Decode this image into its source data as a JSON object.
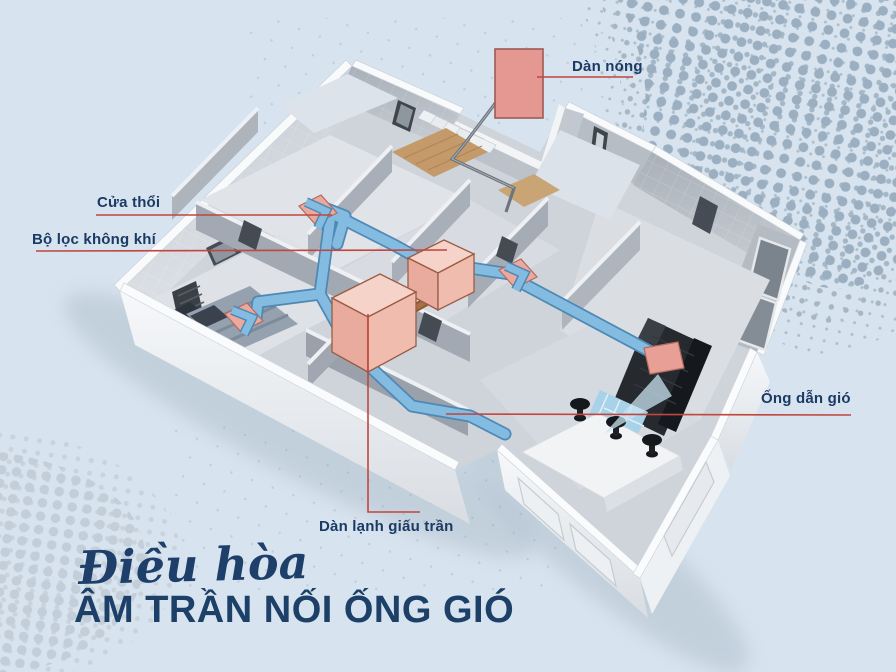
{
  "diagram": {
    "labels": {
      "outdoor_unit": "Dàn nóng",
      "air_outlet": "Cửa thổi",
      "air_filter": "Bộ lọc không khí",
      "air_duct": "Ống dẫn gió",
      "concealed_indoor_unit": "Dàn lạnh giấu trần"
    },
    "title": {
      "script_line": "Điều hòa",
      "main_line": "ÂM TRẦN NỐI ỐNG GIÓ"
    },
    "colors": {
      "background": "#d7e3ee",
      "halftone_dark": "#9cafc0",
      "halftone_light": "#c3ced8",
      "duct_blue": "#83bce0",
      "duct_blue_edge": "#4e88b4",
      "unit_pink": "#eba99d",
      "unit_pink_border": "#a05a50",
      "outdoor_unit_pink": "#e59792",
      "label_line_red": "#c0463f",
      "label_text_navy": "#1b3a64",
      "title_navy": "#1c4067",
      "pipe_brown": "#8f5c31"
    }
  }
}
